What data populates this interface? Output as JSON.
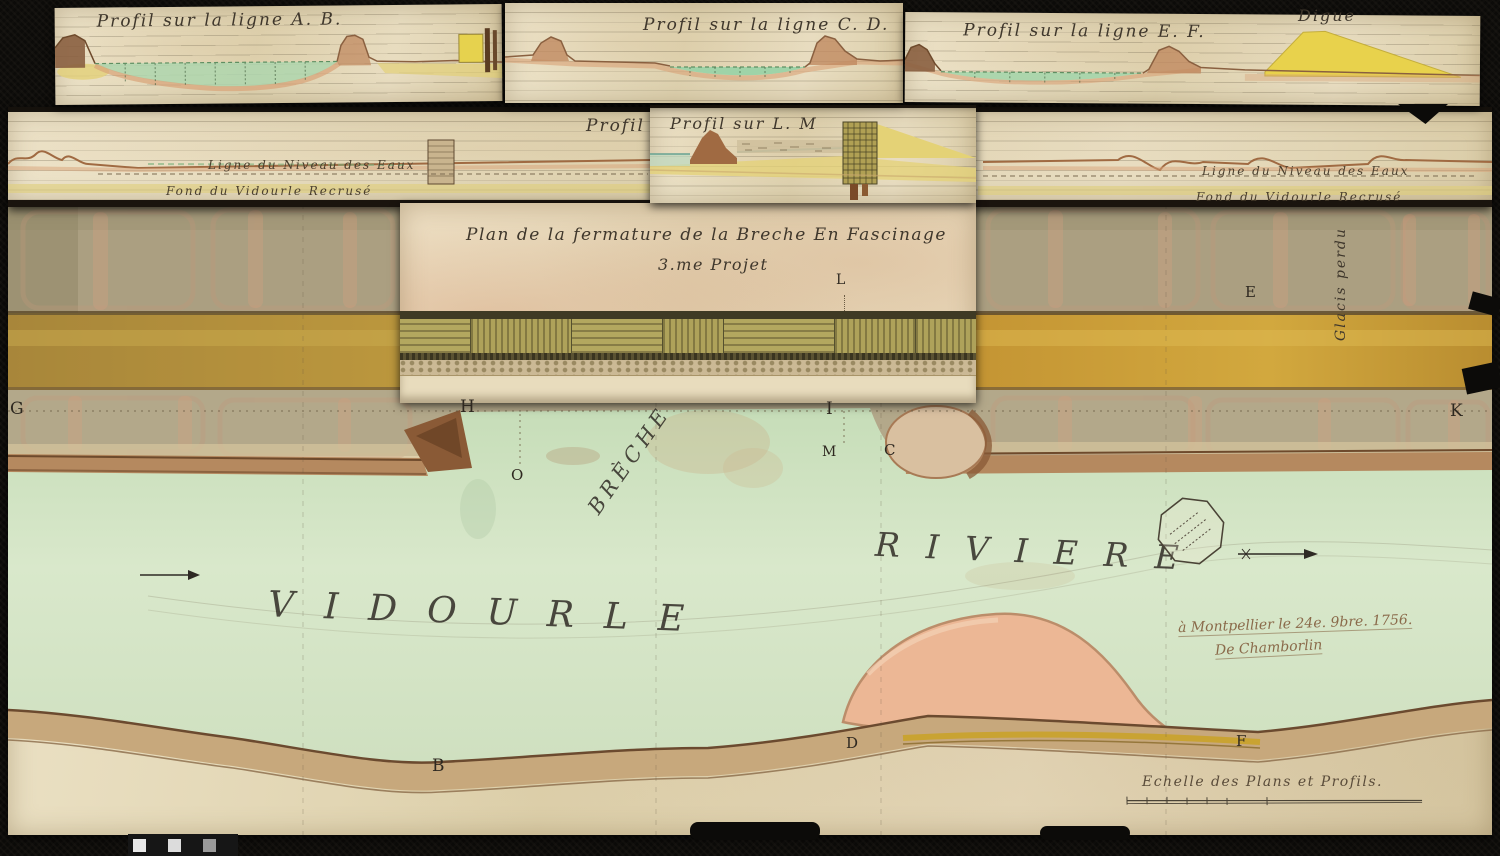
{
  "strips": {
    "ab": {
      "title": "Profil sur la ligne A. B."
    },
    "cd": {
      "title": "Profil sur la ligne C. D."
    },
    "ef": {
      "title": "Profil sur la ligne E. F.",
      "digue_label": "Digue"
    },
    "long_profile": {
      "title_partial": "Profil fu",
      "left": {
        "niveau": "Ligne du Niveau des Eaux",
        "fond": "Fond du Vidourle Recrusé"
      },
      "right": {
        "niveau": "Ligne du Niveau des Eaux",
        "fond": "Fond du Vidourle Recrusé"
      }
    },
    "lm": {
      "title": "Profil sur L. M"
    }
  },
  "plan": {
    "title_line1": "Plan de la fermature de la Breche En Fascinage",
    "title_line2": "3.me Projet",
    "breche_label": "Brèche",
    "glacis_label": "Glacis perdu",
    "river_word_left": "VIDOURLE",
    "river_word_right": "RIVIERE",
    "markers": [
      "G",
      "H",
      "I",
      "K",
      "L",
      "E",
      "M",
      "C",
      "O",
      "B",
      "D",
      "F"
    ]
  },
  "footer": {
    "place_date": "à Montpellier le 24e. 9bre. 1756.",
    "signature": "De Chamborlin",
    "scale_label": "Echelle des Plans et Profils."
  },
  "colors": {
    "paper": "#e6d9b8",
    "ink": "#3f372c",
    "river_green": "#cfe2c2",
    "ochre_band": "#c8952e",
    "dike_yellow": "#e8d24c",
    "bank_brown": "#9b6f4c"
  }
}
